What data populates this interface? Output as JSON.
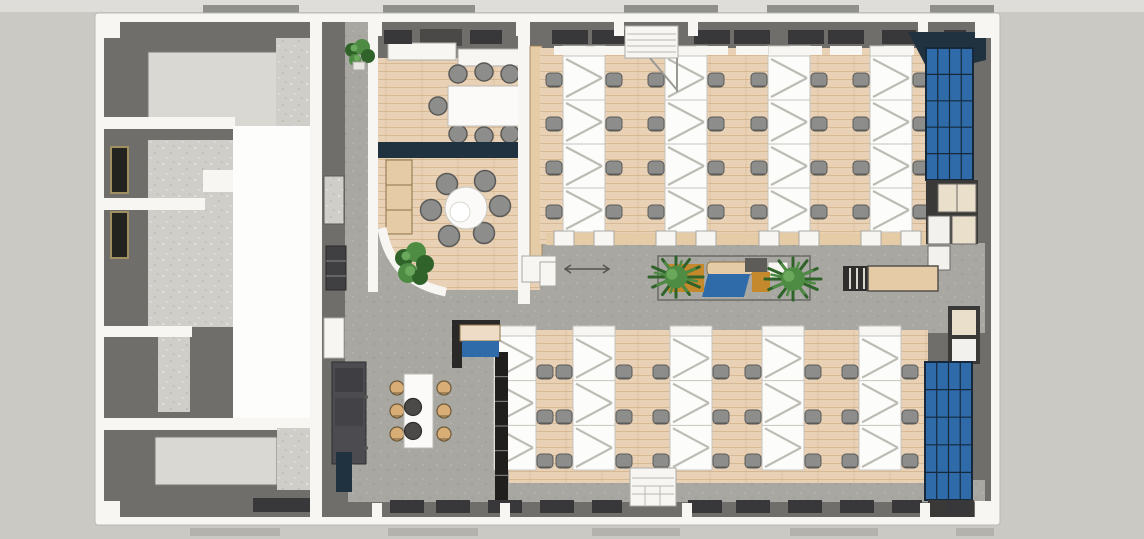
{
  "meta": {
    "scene": "3d-office-floor-plan-render",
    "view": "top-down-axonometric"
  },
  "regions": {
    "left_block": "service-rooms",
    "corridor": "central-corridor",
    "meeting_room": "conference-room",
    "lounge": "lounge-meeting-room",
    "office_top": "open-office-north",
    "office_bottom": "open-office-south",
    "cafe": "cafe-high-table-area",
    "island": "planted-seating-island",
    "lockers_top": "blue-locker-wall-north",
    "lockers_bottom": "blue-locker-wall-south",
    "entrance_top": "north-entrance-steps",
    "entrance_bottom": "south-entrance-steps"
  },
  "palette": {
    "bg": "#cac9c4",
    "bg-top": "#deddda",
    "wall-outer": "#f7f6f3",
    "wall-dark": "#6f6e6b",
    "wall-darker": "#4a4947",
    "conc-room": "#cfcec9",
    "conc-corridor": "#a8a7a2",
    "slab": "#d9d8d2",
    "white-room": "#fdfdfc",
    "wood": "#e9d1b5",
    "wood-line": "#c49b72",
    "navy": "#20313f",
    "blue": "#2e6ba8",
    "blue-grid": "#16293c",
    "mustard": "#c5892d",
    "green": "#4e8c44",
    "green-dark": "#2f6329",
    "green-light": "#6aa85b",
    "tan": "#e5cba6",
    "tan-frame": "#a08f5f",
    "desk": "#fcfcfa",
    "desk-line": "#c6c5bd",
    "trestle": "#bdbcb4",
    "chair": "#8d8d8b",
    "chair-dark": "#5a5a58",
    "stool": "#d9ad76",
    "dark-unit": "#3a3937",
    "near-black": "#201f1e",
    "pane": "#38383a",
    "cream": "#eadfca",
    "sill-top": "#8f8f8c",
    "sill-bottom": "#b3b2ad"
  },
  "layout": {
    "top_sills": [
      [
        203,
        96
      ],
      [
        383,
        92
      ],
      [
        624,
        94
      ],
      [
        767,
        92
      ],
      [
        930,
        64
      ]
    ],
    "bottom_sills": [
      [
        190,
        90
      ],
      [
        388,
        90
      ],
      [
        592,
        88
      ],
      [
        790,
        88
      ],
      [
        956,
        38
      ]
    ],
    "top_panes": [
      [
        384,
        28
      ],
      [
        470,
        32
      ],
      [
        552,
        36
      ],
      [
        592,
        36
      ],
      [
        694,
        36
      ],
      [
        734,
        36
      ],
      [
        788,
        36
      ],
      [
        828,
        36
      ],
      [
        882,
        34
      ],
      [
        944,
        22
      ]
    ],
    "bottom_panes": [
      [
        390,
        34
      ],
      [
        436,
        34
      ],
      [
        488,
        34
      ],
      [
        540,
        34
      ],
      [
        592,
        30
      ],
      [
        688,
        34
      ],
      [
        736,
        34
      ],
      [
        788,
        34
      ],
      [
        840,
        34
      ],
      [
        892,
        30
      ],
      [
        946,
        24
      ]
    ],
    "wall_posts_top": [
      372,
      516,
      614,
      688,
      918
    ],
    "wall_posts_bottom": [
      372,
      500,
      682,
      920
    ],
    "office_top": {
      "row_centers": [
        584,
        686,
        789,
        891
      ],
      "row_top": 56,
      "row_bottom": 232,
      "segments": 4,
      "desk_half": 21,
      "chair_ys": [
        80,
        124,
        168,
        212
      ],
      "chair_offset": 30,
      "cap_y": 46
    },
    "office_bottom": {
      "row_centers": [
        515,
        594,
        691,
        783,
        880
      ],
      "row_top": 336,
      "row_bottom": 470,
      "segments": 3,
      "desk_half": 21,
      "chair_ys": [
        372,
        417,
        461
      ],
      "chair_offset": 30,
      "cap_y": 326,
      "sides_by_row": [
        [
          "R"
        ],
        [
          "L",
          "R"
        ],
        [
          "L",
          "R"
        ],
        [
          "L",
          "R"
        ],
        [
          "L",
          "R"
        ]
      ]
    },
    "meeting": {
      "table": [
        448,
        86,
        72,
        40
      ],
      "chairs": [
        [
          458,
          74
        ],
        [
          484,
          72
        ],
        [
          510,
          74
        ],
        [
          458,
          134
        ],
        [
          484,
          136
        ],
        [
          510,
          134
        ],
        [
          438,
          106
        ]
      ]
    },
    "lounge": {
      "table_center": [
        466,
        208
      ],
      "table_r": 21,
      "chairs": [
        [
          447,
          184
        ],
        [
          485,
          181
        ],
        [
          500,
          206
        ],
        [
          484,
          233
        ],
        [
          449,
          236
        ],
        [
          431,
          210
        ]
      ]
    },
    "cafe": {
      "table": [
        404,
        374,
        29,
        74
      ],
      "stools": [
        [
          397,
          388
        ],
        [
          397,
          411
        ],
        [
          397,
          434
        ],
        [
          444,
          388
        ],
        [
          444,
          411
        ],
        [
          444,
          434
        ]
      ],
      "dark_seats": [
        [
          413,
          407
        ],
        [
          413,
          431
        ]
      ],
      "dots": [
        [
          366,
          397
        ],
        [
          366,
          448
        ]
      ]
    },
    "island": {
      "palms": [
        [
          676,
          277,
          27
        ],
        [
          793,
          279,
          28
        ]
      ]
    },
    "plants": {
      "corridor": [
        [
          352,
          50,
          7
        ],
        [
          362,
          47,
          8
        ],
        [
          368,
          56,
          7
        ],
        [
          355,
          60,
          6
        ]
      ],
      "lounge": [
        [
          404,
          258,
          9
        ],
        [
          416,
          252,
          10
        ],
        [
          425,
          264,
          9
        ],
        [
          408,
          273,
          10
        ],
        [
          420,
          277,
          8
        ]
      ]
    },
    "locker_grid_top": {
      "x": 926,
      "y": 48,
      "w": 47,
      "h": 132,
      "cols": 4,
      "rows": 5
    },
    "locker_grid_bottom": {
      "x": 925,
      "y": 362,
      "w": 47,
      "h": 138,
      "cols": 4,
      "rows": 5
    },
    "shelf_lines": {
      "x": 495,
      "y": 352,
      "w": 13,
      "h": 148,
      "n": 5
    }
  }
}
